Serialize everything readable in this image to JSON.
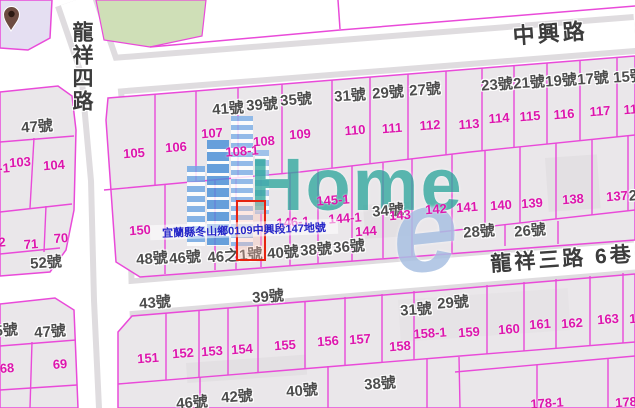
{
  "map": {
    "roads": [
      {
        "name": "中興路"
      },
      {
        "name": "龍祥四路"
      },
      {
        "name": "龍祥三路  6巷"
      }
    ],
    "selected_parcel": {
      "address": "宜蘭縣冬山鄉0109中興段147地號",
      "parcel_no": "147"
    },
    "labels": [
      {
        "t": "41號",
        "x": 228,
        "y": 109,
        "k": "h"
      },
      {
        "t": "39號",
        "x": 262,
        "y": 105,
        "k": "h"
      },
      {
        "t": "35號",
        "x": 296,
        "y": 100,
        "k": "h"
      },
      {
        "t": "31號",
        "x": 350,
        "y": 96,
        "k": "h"
      },
      {
        "t": "29號",
        "x": 388,
        "y": 93,
        "k": "h"
      },
      {
        "t": "27號",
        "x": 425,
        "y": 90,
        "k": "h"
      },
      {
        "t": "23號",
        "x": 497,
        "y": 85,
        "k": "h"
      },
      {
        "t": "21號",
        "x": 529,
        "y": 83,
        "k": "h"
      },
      {
        "t": "19號",
        "x": 561,
        "y": 81,
        "k": "h"
      },
      {
        "t": "17號",
        "x": 593,
        "y": 79,
        "k": "h"
      },
      {
        "t": "15號",
        "x": 629,
        "y": 77,
        "k": "h"
      },
      {
        "t": "47號",
        "x": 37,
        "y": 127,
        "k": "h"
      },
      {
        "t": "52號",
        "x": 46,
        "y": 263,
        "k": "h"
      },
      {
        "t": "45號",
        "x": 2,
        "y": 331,
        "k": "h"
      },
      {
        "t": "47號",
        "x": 50,
        "y": 332,
        "k": "h"
      },
      {
        "t": "48號",
        "x": 152,
        "y": 259,
        "k": "h"
      },
      {
        "t": "46號",
        "x": 185,
        "y": 258,
        "k": "h"
      },
      {
        "t": "46之1號",
        "x": 235,
        "y": 256,
        "k": "h"
      },
      {
        "t": "40號",
        "x": 283,
        "y": 253,
        "k": "h"
      },
      {
        "t": "38號",
        "x": 316,
        "y": 250,
        "k": "h"
      },
      {
        "t": "36號",
        "x": 349,
        "y": 247,
        "k": "h"
      },
      {
        "t": "34號",
        "x": 388,
        "y": 211,
        "k": "h"
      },
      {
        "t": "28號",
        "x": 479,
        "y": 232,
        "k": "h"
      },
      {
        "t": "26號",
        "x": 530,
        "y": 231,
        "k": "h"
      },
      {
        "t": "2",
        "x": 633,
        "y": 196,
        "k": "h"
      },
      {
        "t": "43號",
        "x": 155,
        "y": 303,
        "k": "h"
      },
      {
        "t": "39號",
        "x": 268,
        "y": 297,
        "k": "h"
      },
      {
        "t": "31號",
        "x": 416,
        "y": 310,
        "k": "h"
      },
      {
        "t": "29號",
        "x": 453,
        "y": 303,
        "k": "h"
      },
      {
        "t": "46號",
        "x": 192,
        "y": 403,
        "k": "h"
      },
      {
        "t": "42號",
        "x": 237,
        "y": 397,
        "k": "h"
      },
      {
        "t": "40號",
        "x": 302,
        "y": 391,
        "k": "h"
      },
      {
        "t": "38號",
        "x": 380,
        "y": 384,
        "k": "h"
      },
      {
        "t": "103",
        "x": 20,
        "y": 162,
        "k": "p"
      },
      {
        "t": "104",
        "x": 54,
        "y": 165,
        "k": "p"
      },
      {
        "t": "-1",
        "x": 4,
        "y": 168,
        "k": "p"
      },
      {
        "t": "105",
        "x": 134,
        "y": 153,
        "k": "p"
      },
      {
        "t": "106",
        "x": 176,
        "y": 147,
        "k": "p"
      },
      {
        "t": "107",
        "x": 212,
        "y": 133,
        "k": "p"
      },
      {
        "t": "108-1",
        "x": 242,
        "y": 151,
        "k": "p"
      },
      {
        "t": "108",
        "x": 264,
        "y": 141,
        "k": "p"
      },
      {
        "t": "109",
        "x": 300,
        "y": 134,
        "k": "p"
      },
      {
        "t": "110",
        "x": 355,
        "y": 130,
        "k": "p"
      },
      {
        "t": "111",
        "x": 392,
        "y": 128,
        "k": "p"
      },
      {
        "t": "112",
        "x": 430,
        "y": 125,
        "k": "p"
      },
      {
        "t": "113",
        "x": 469,
        "y": 124,
        "k": "p"
      },
      {
        "t": "114",
        "x": 499,
        "y": 118,
        "k": "p"
      },
      {
        "t": "115",
        "x": 530,
        "y": 116,
        "k": "p"
      },
      {
        "t": "116",
        "x": 564,
        "y": 114,
        "k": "p"
      },
      {
        "t": "117",
        "x": 600,
        "y": 111,
        "k": "p"
      },
      {
        "t": "118",
        "x": 634,
        "y": 109,
        "k": "p"
      },
      {
        "t": "2",
        "x": 2,
        "y": 242,
        "k": "p"
      },
      {
        "t": "71",
        "x": 31,
        "y": 244,
        "k": "p"
      },
      {
        "t": "70",
        "x": 61,
        "y": 238,
        "k": "p"
      },
      {
        "t": "68",
        "x": 7,
        "y": 368,
        "k": "p"
      },
      {
        "t": "69",
        "x": 60,
        "y": 364,
        "k": "p"
      },
      {
        "t": "150",
        "x": 140,
        "y": 230,
        "k": "p"
      },
      {
        "t": "146-1",
        "x": 293,
        "y": 222,
        "k": "p"
      },
      {
        "t": "145-1",
        "x": 333,
        "y": 200,
        "k": "p"
      },
      {
        "t": "144-1",
        "x": 345,
        "y": 218,
        "k": "p"
      },
      {
        "t": "144",
        "x": 366,
        "y": 231,
        "k": "p"
      },
      {
        "t": "143",
        "x": 400,
        "y": 215,
        "k": "p"
      },
      {
        "t": "142",
        "x": 436,
        "y": 209,
        "k": "p"
      },
      {
        "t": "141",
        "x": 467,
        "y": 207,
        "k": "p"
      },
      {
        "t": "140",
        "x": 501,
        "y": 205,
        "k": "p"
      },
      {
        "t": "139",
        "x": 532,
        "y": 203,
        "k": "p"
      },
      {
        "t": "138",
        "x": 573,
        "y": 199,
        "k": "p"
      },
      {
        "t": "137",
        "x": 617,
        "y": 196,
        "k": "p"
      },
      {
        "t": "151",
        "x": 148,
        "y": 358,
        "k": "p"
      },
      {
        "t": "152",
        "x": 183,
        "y": 353,
        "k": "p"
      },
      {
        "t": "153",
        "x": 212,
        "y": 351,
        "k": "p"
      },
      {
        "t": "154",
        "x": 242,
        "y": 349,
        "k": "p"
      },
      {
        "t": "155",
        "x": 285,
        "y": 345,
        "k": "p"
      },
      {
        "t": "156",
        "x": 328,
        "y": 341,
        "k": "p"
      },
      {
        "t": "157",
        "x": 360,
        "y": 339,
        "k": "p"
      },
      {
        "t": "158",
        "x": 400,
        "y": 346,
        "k": "p"
      },
      {
        "t": "158-1",
        "x": 430,
        "y": 333,
        "k": "p"
      },
      {
        "t": "159",
        "x": 469,
        "y": 332,
        "k": "p"
      },
      {
        "t": "160",
        "x": 509,
        "y": 329,
        "k": "p"
      },
      {
        "t": "161",
        "x": 540,
        "y": 324,
        "k": "p"
      },
      {
        "t": "162",
        "x": 572,
        "y": 323,
        "k": "p"
      },
      {
        "t": "163",
        "x": 608,
        "y": 319,
        "k": "p"
      },
      {
        "t": "164",
        "x": 640,
        "y": 318,
        "k": "p"
      },
      {
        "t": "178-1",
        "x": 547,
        "y": 403,
        "k": "p"
      },
      {
        "t": "178",
        "x": 626,
        "y": 402,
        "k": "p"
      }
    ]
  },
  "watermark": {
    "brand": "Home",
    "swoosh": "e"
  },
  "colors": {
    "parcel_line": "#e94ad9",
    "parcel_fill": "#eae7ea",
    "parcel_number": "#dd16ad",
    "house_label": "#4d4d4d",
    "road_label": "#3c3c3c",
    "selected_outline": "#e62310",
    "address_text": "#2526c8",
    "watermark_teal": "#2fa79d",
    "watermark_blue": "#a9c0e2",
    "green_parcel": "#cfdfb7",
    "lavender_parcel": "#e5dff2",
    "road_edge": "#dfdcdf"
  }
}
